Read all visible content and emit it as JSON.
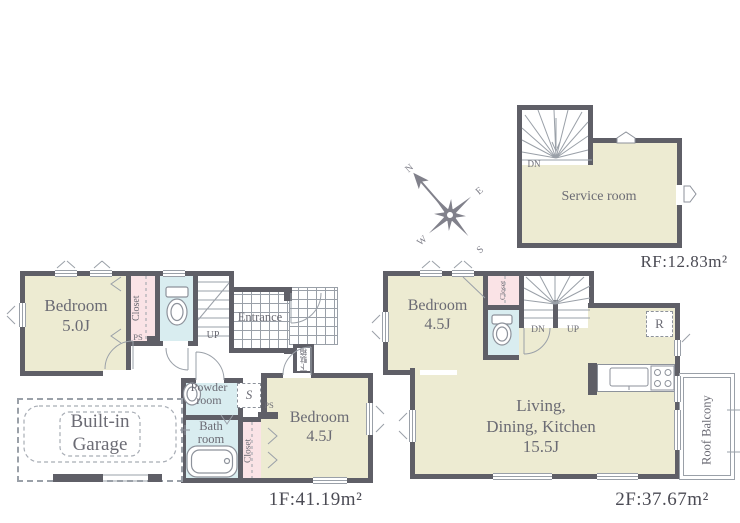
{
  "palette": {
    "wall": "#5f5f67",
    "room": "#edebd2",
    "closet": "#fae3e6",
    "wet": "#d9edf0",
    "line": "#9aa0a8",
    "text": "#6b6b74",
    "label": "#4b4b54"
  },
  "compass": {
    "n": "N",
    "e": "E",
    "s": "S",
    "w": "W"
  },
  "floor1": {
    "area_label": "1F:41.19m²",
    "bedroom_a": "Bedroom\n5.0J",
    "closet_a": "Closet",
    "ps_a": "PS",
    "up": "UP",
    "entrance": "Entrance",
    "shoe_cabinet": "下駄箱",
    "powder_room": "Powder\nroom",
    "s_mark": "S",
    "ps_b": "PS",
    "bath_room": "Bath\nroom",
    "closet_b": "Closet",
    "bedroom_b": "Bedroom\n4.5J",
    "garage": "Built-in\nGarage"
  },
  "floor2": {
    "area_label": "2F:37.67m²",
    "bedroom": "Bedroom\n4.5J",
    "closet": "Closet",
    "dn": "DN",
    "up": "UP",
    "fridge": "R",
    "ldk": "Living,\nDining, Kitchen\n15.5J",
    "balcony": "Roof Balcony"
  },
  "roof": {
    "area_label": "RF:12.83m²",
    "dn": "DN",
    "service_room": "Service room"
  }
}
